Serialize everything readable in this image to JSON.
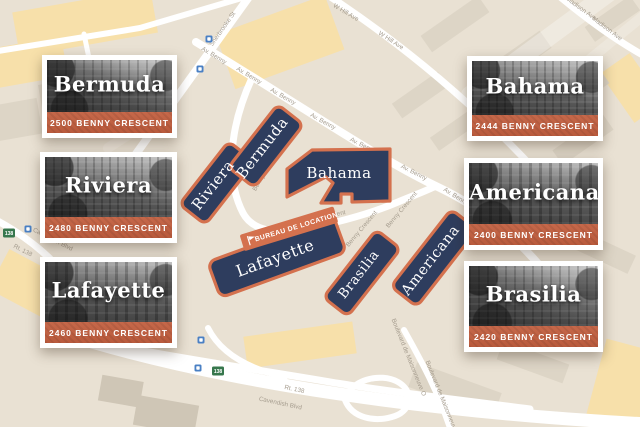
{
  "colors": {
    "map_background": "#e9e1d3",
    "building_fill": "#2e3d5e",
    "building_border": "#d4714e",
    "rental_office_banner": "#d4714e",
    "card_address_bar": "#bf5e40",
    "road": "#ffffff",
    "street_label": "#a59c8e",
    "yellow_block": "#f7e0aa",
    "footprint_block": "#ddd5c6",
    "transit_blue": "#4a80c4",
    "shield_green": "#37774d"
  },
  "map": {
    "street_labels": {
      "sherbrooke": "Sherbrooke St",
      "av_benny": "Av. Benny",
      "w_hill": "W Hill Ave",
      "madison": "Madison Ave",
      "benny_crescent": "Benny Crescent",
      "cavendish": "Cavendish Blvd",
      "rt_138": "Rt. 138",
      "maisonneuve": "Boulevard de Maisonneuve O",
      "route_shield": "138"
    },
    "buildings": {
      "riviera": "Riviera",
      "bermuda": "Bermuda",
      "bahama": "Bahama",
      "lafayette": "Lafayette",
      "brasilia": "Brasilia",
      "americana": "Americana"
    },
    "rental_office_label": "BUREAU DE LOCATION"
  },
  "cards": [
    {
      "name": "Bermuda",
      "address": "2500 BENNY CRESCENT"
    },
    {
      "name": "Riviera",
      "address": "2480 BENNY CRESCENT"
    },
    {
      "name": "Lafayette",
      "address": "2460 BENNY CRESCENT"
    },
    {
      "name": "Bahama",
      "address": "2444 BENNY CRESCENT"
    },
    {
      "name": "Americana",
      "address": "2400 BENNY CRESCENT"
    },
    {
      "name": "Brasilia",
      "address": "2420 BENNY CRESCENT"
    }
  ]
}
